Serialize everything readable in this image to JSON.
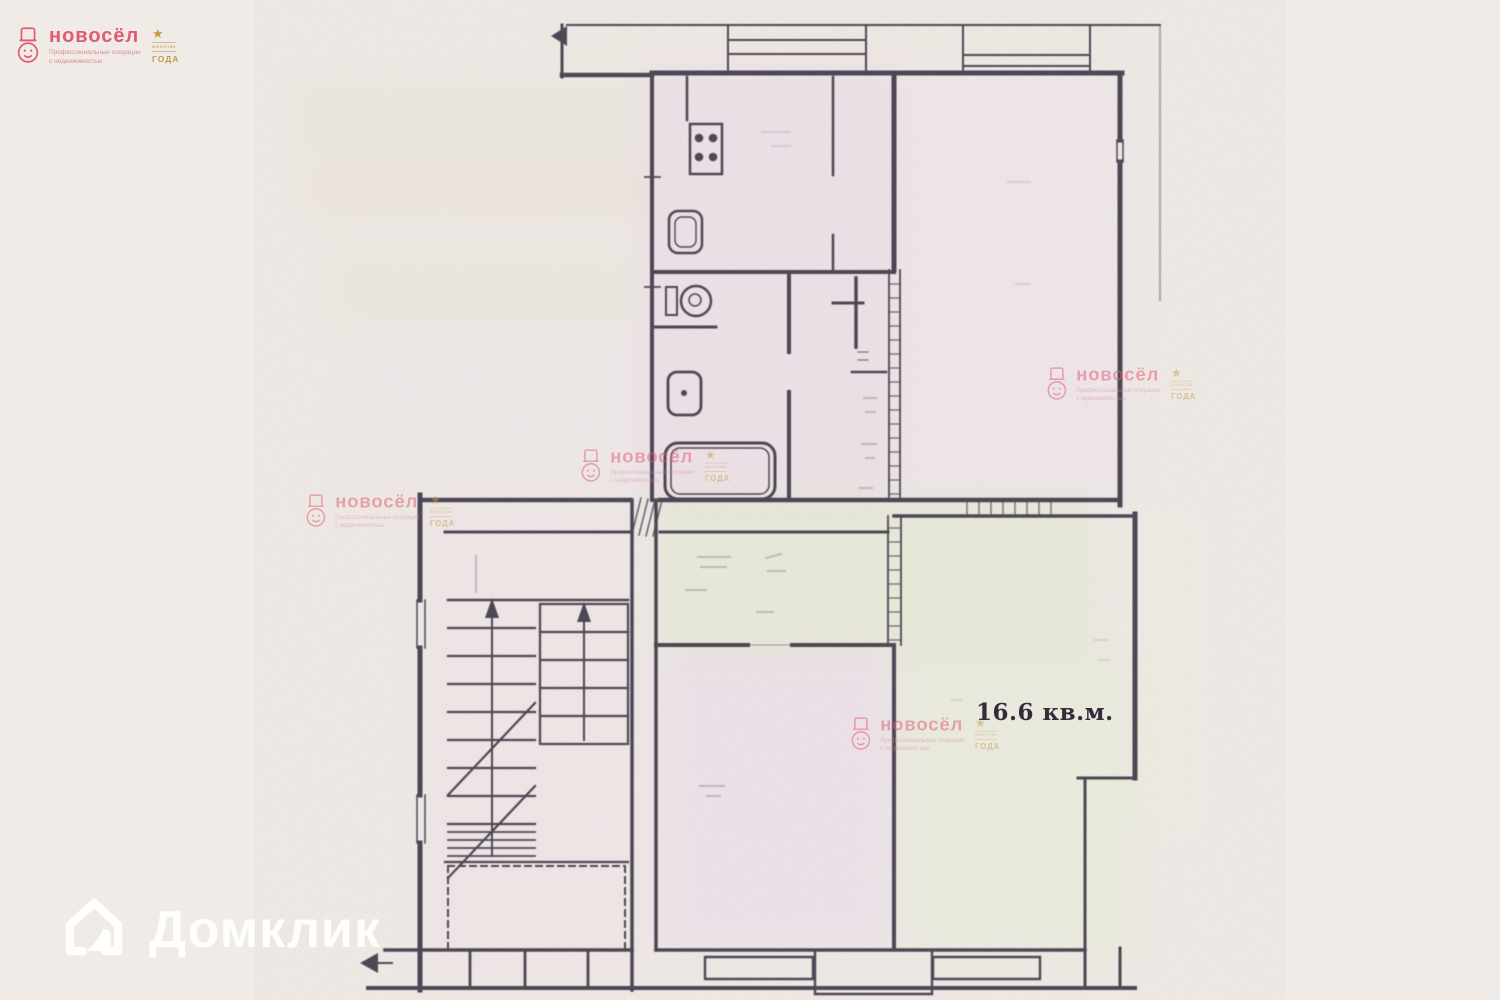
{
  "page": {
    "paper_color": "#f0ebe6",
    "ink_color": "#4b4552"
  },
  "branding": {
    "novosel": {
      "name": "новосёл",
      "tagline": "Профессиональные операции с недвижимостью",
      "award_caption": "агентство",
      "award_word": "ГОДА",
      "pink": "#e05a72",
      "gold": "#c59b42"
    },
    "domclick": {
      "name": "Домклик"
    }
  },
  "floorplan": {
    "kind": "scanned apartment floor plan",
    "area_label": "16.6 кв.м.",
    "features": [
      "entry-arrow-top",
      "entry-arrow-bottom",
      "balcony-top-left",
      "balcony-top-right",
      "kitchen-stove",
      "kitchen-sink",
      "wc-toilet",
      "washbasin",
      "bathtub",
      "hall-closet",
      "entry-door-hatch",
      "staircase-two-flights",
      "stair-up-arrows",
      "stair-break-lines",
      "porch-dashed-outline",
      "bottom-window-left",
      "bottom-window-right",
      "bottom-porch",
      "room-16-6"
    ]
  }
}
